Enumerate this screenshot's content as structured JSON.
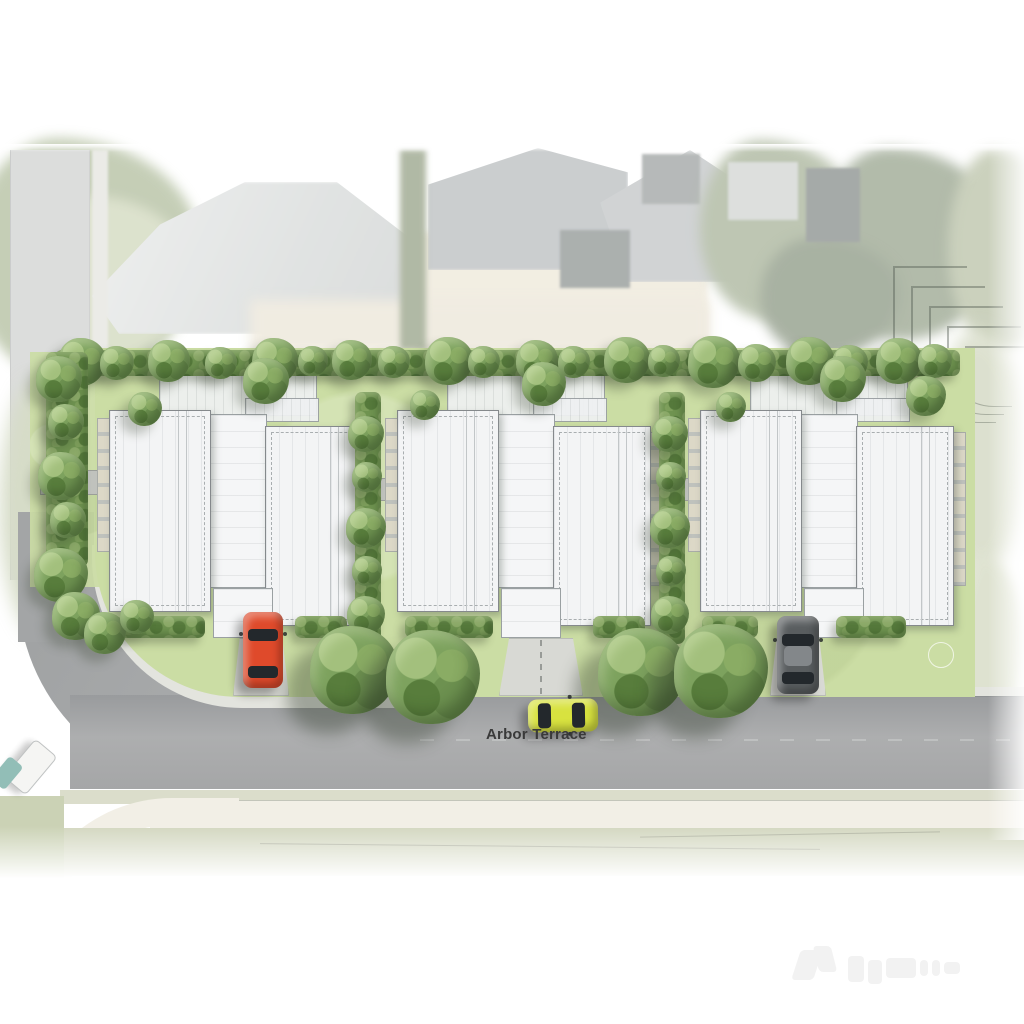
{
  "scene": {
    "street_label": "Arbor Terrace",
    "lot_count": 3,
    "buildings_per_lot": 2,
    "street_tree_pairs": 2,
    "cars": [
      {
        "id": "red-car",
        "color": "#df4a2b",
        "parked": "driveway-lot-1"
      },
      {
        "id": "yellow-car",
        "color": "#d8e23f",
        "parked": "street"
      },
      {
        "id": "grey-car",
        "color": "#595d5f",
        "parked": "driveway-lot-3"
      }
    ]
  },
  "palette": {
    "lawn": "#cbdda4",
    "hedge": "#6f9350",
    "tree": "#7da25e",
    "road": "#a5a7a8",
    "roof": "#f3f4f5",
    "roofLine": "#85898c",
    "path": "#d8d9d4",
    "kerb": "#e3e4de",
    "labelColor": "#3a3a3a"
  }
}
